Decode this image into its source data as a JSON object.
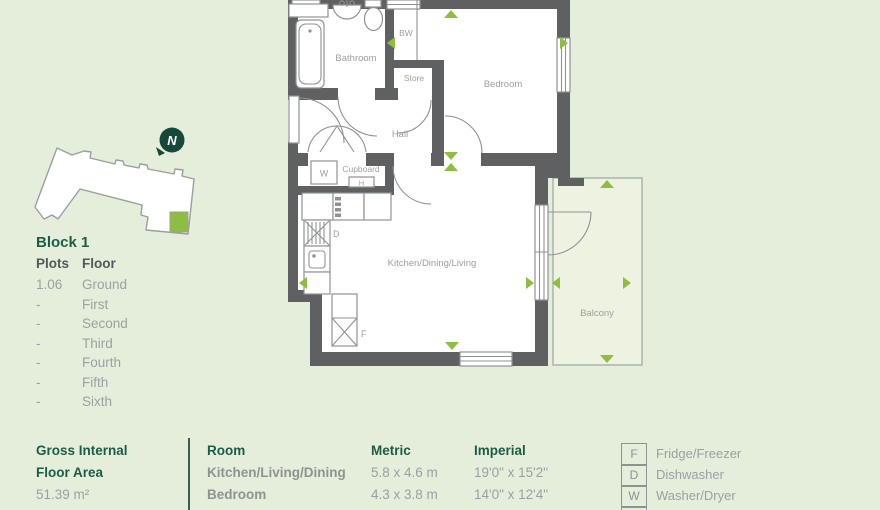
{
  "palette": {
    "background": "#e5eedb",
    "wall_gray": "#5e6062",
    "accent_green": "#8dbe3f",
    "heading_green": "#1c5c45",
    "line_gray": "#8f9294",
    "text_gray": "#9aa0a2",
    "north_pin_green": "#17493a",
    "balcony_fill": "#eef3e1"
  },
  "locator": {
    "north_label": "N",
    "block_title": "Block 1",
    "plots_header": "Plots",
    "floor_header": "Floor",
    "rows": [
      {
        "plot": "1.06",
        "floor": "Ground"
      },
      {
        "plot": "-",
        "floor": "First"
      },
      {
        "plot": "-",
        "floor": "Second"
      },
      {
        "plot": "-",
        "floor": "Third"
      },
      {
        "plot": "-",
        "floor": "Fourth"
      },
      {
        "plot": "-",
        "floor": "Fifth"
      },
      {
        "plot": "-",
        "floor": "Sixth"
      }
    ]
  },
  "plan": {
    "labels": {
      "bathroom": "Bathroom",
      "bw": "BW",
      "store": "Store",
      "bedroom": "Bedroom",
      "hall": "Hall",
      "cupboard": "Cupboard",
      "kitchen": "Kitchen/Dining/Living",
      "balcony": "Balcony"
    },
    "appliances": {
      "washer": "W",
      "heater": "H",
      "dishwasher": "D",
      "fridge": "F"
    }
  },
  "footer": {
    "gross_line1": "Gross Internal",
    "gross_line2": "Floor Area",
    "gross_value": "51.39 m²",
    "room_header": "Room",
    "metric_header": "Metric",
    "imperial_header": "Imperial",
    "rows": [
      {
        "room": "Kitchen/Living/Dining",
        "metric": "5.8 x 4.6 m",
        "imperial": "19'0\" x 15'2\""
      },
      {
        "room": "Bedroom",
        "metric": "4.3 x 3.8 m",
        "imperial": "14'0\" x 12'4\""
      }
    ],
    "legend": [
      {
        "key": "F",
        "label": "Fridge/Freezer"
      },
      {
        "key": "D",
        "label": "Dishwasher"
      },
      {
        "key": "W",
        "label": "Washer/Dryer"
      }
    ]
  }
}
